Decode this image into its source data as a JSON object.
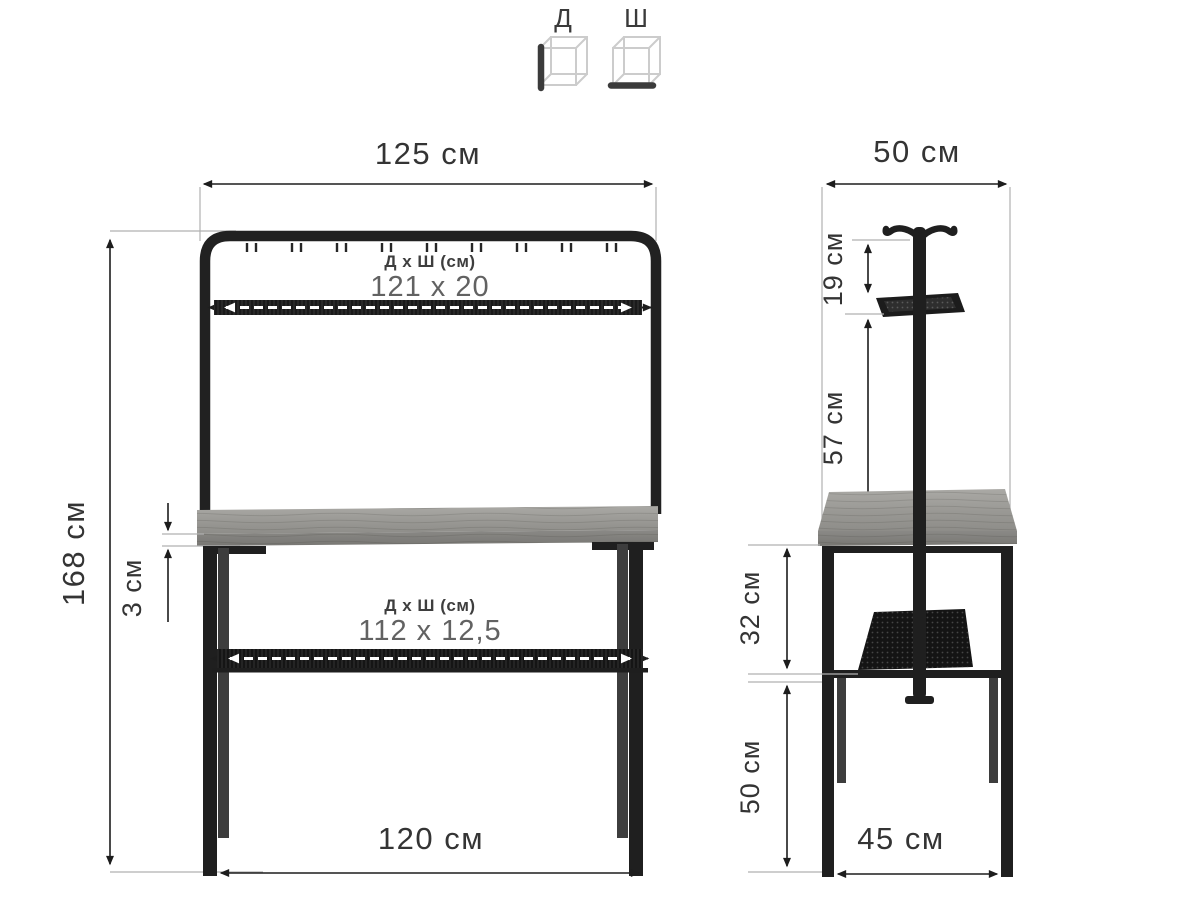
{
  "legend": {
    "depth_label": "Д",
    "width_label": "Ш"
  },
  "front_view": {
    "top_width": "125 см",
    "height": "168 см",
    "rail_shelf_label": "Д х Ш (см)",
    "rail_shelf_value": "121 x 20",
    "top_thickness": "3 см",
    "lower_shelf_label": "Д х Ш (см)",
    "lower_shelf_value": "112 x 12,5",
    "bottom_width": "120 см"
  },
  "side_view": {
    "top_depth": "50 см",
    "hook_drop": "19 см",
    "stand_height": "57 см",
    "apron_gap": "32 см",
    "leg_clearance": "50 см",
    "bottom_depth": "45 см"
  },
  "colors": {
    "background": "#ffffff",
    "frame_black": "#1f1f1f",
    "rear_leg_gray": "#3d3d3d",
    "wood_light": "#a7a6a2",
    "wood_dark": "#7b7a77",
    "dimension_line": "#1d1d1d",
    "extension_line": "#b0b0b0",
    "value_text": "#626262"
  }
}
